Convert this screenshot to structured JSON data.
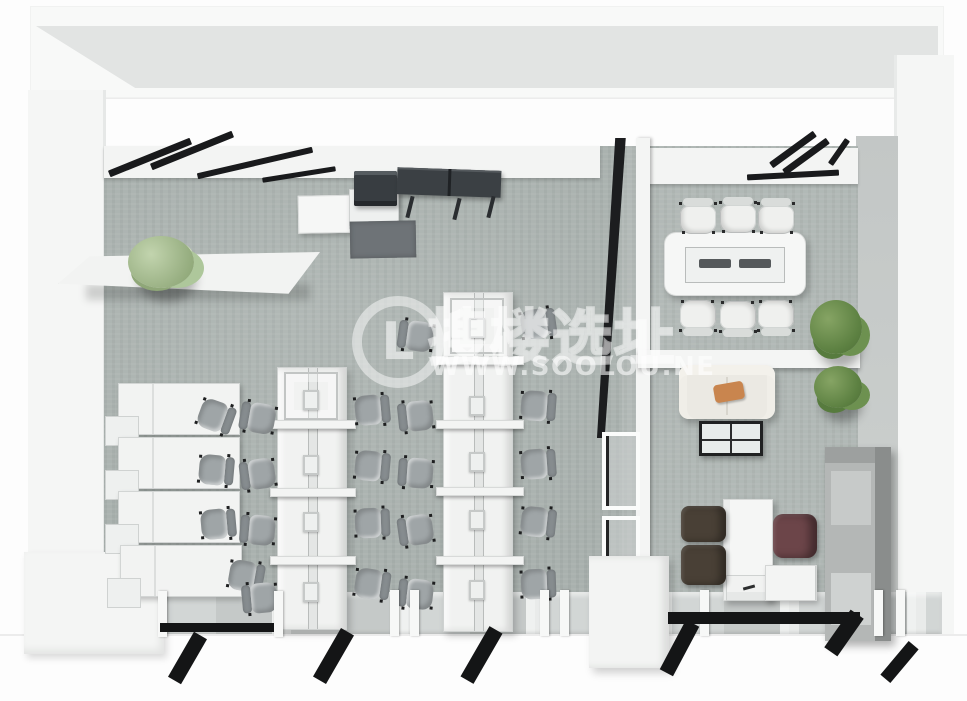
{
  "watermark": {
    "logo_glyph": "L",
    "brand_cjk": "搜楼选址",
    "brand_url": "WWW.SOOLOU.NE"
  },
  "scene": {
    "type": "3d-office-floorplan-render",
    "rooms": [
      "open-office",
      "conference-room",
      "lounge",
      "private-office"
    ],
    "palette": {
      "floor": "#a9b1ae",
      "wall_white": "#f5f6f5",
      "wall_gray": "#c9cdcb",
      "mullion_black": "#191a1c",
      "chair_gray": "#9fa5a7",
      "chair_white": "#eff0ee",
      "chair_brown": "#494036",
      "chair_maroon": "#6c4549",
      "sofa_cream": "#ebe9e3",
      "pillow_orange": "#c9854e",
      "plant_green": "#5d8142",
      "plant_light_green": "#9ab184",
      "cabinet_gray": "#b4b7b6",
      "console_dark": "#3b4044"
    }
  },
  "items": [
    {
      "k": "bank",
      "x": 277,
      "y": 367,
      "w": 70,
      "h": 263
    },
    {
      "k": "bank",
      "x": 443,
      "y": 292,
      "w": 70,
      "h": 340
    },
    {
      "k": "bankframe",
      "x": 284,
      "y": 372,
      "w": 54,
      "h": 48
    },
    {
      "k": "bankframe",
      "x": 450,
      "y": 298,
      "w": 54,
      "h": 56
    },
    {
      "k": "crossbar",
      "x": 270,
      "y": 420,
      "w": 86,
      "h": 9
    },
    {
      "k": "crossbar",
      "x": 270,
      "y": 488,
      "w": 86,
      "h": 9
    },
    {
      "k": "crossbar",
      "x": 270,
      "y": 556,
      "w": 86,
      "h": 9
    },
    {
      "k": "crossbar",
      "x": 436,
      "y": 356,
      "w": 88,
      "h": 9
    },
    {
      "k": "crossbar",
      "x": 436,
      "y": 420,
      "w": 88,
      "h": 9
    },
    {
      "k": "crossbar",
      "x": 436,
      "y": 487,
      "w": 88,
      "h": 9
    },
    {
      "k": "crossbar",
      "x": 436,
      "y": 556,
      "w": 88,
      "h": 9
    },
    {
      "k": "monitor",
      "x": 303,
      "y": 390
    },
    {
      "k": "monitor",
      "x": 303,
      "y": 455
    },
    {
      "k": "monitor",
      "x": 303,
      "y": 512
    },
    {
      "k": "monitor",
      "x": 303,
      "y": 582
    },
    {
      "k": "monitor",
      "x": 469,
      "y": 318
    },
    {
      "k": "monitor",
      "x": 469,
      "y": 396
    },
    {
      "k": "monitor",
      "x": 469,
      "y": 452
    },
    {
      "k": "monitor",
      "x": 469,
      "y": 510
    },
    {
      "k": "monitor",
      "x": 469,
      "y": 580
    },
    {
      "k": "wallunit",
      "x": 118,
      "y": 383
    },
    {
      "k": "wallunit",
      "x": 118,
      "y": 437
    },
    {
      "k": "wallunit",
      "x": 118,
      "y": 491
    },
    {
      "k": "wallunit",
      "x": 120,
      "y": 545
    },
    {
      "k": "chair",
      "x": 196,
      "y": 398,
      "r": 200
    },
    {
      "k": "chair",
      "x": 196,
      "y": 452,
      "r": 185
    },
    {
      "k": "chair",
      "x": 198,
      "y": 506,
      "r": 175
    },
    {
      "k": "chair",
      "x": 226,
      "y": 558,
      "r": 190
    },
    {
      "k": "chair",
      "x": 240,
      "y": 400,
      "r": 10
    },
    {
      "k": "chair",
      "x": 240,
      "y": 456,
      "r": -8
    },
    {
      "k": "chair",
      "x": 240,
      "y": 512,
      "r": 5
    },
    {
      "k": "chair",
      "x": 242,
      "y": 580,
      "r": -5
    },
    {
      "k": "chair",
      "x": 352,
      "y": 392,
      "r": 175
    },
    {
      "k": "chair",
      "x": 352,
      "y": 448,
      "r": 185
    },
    {
      "k": "chair",
      "x": 352,
      "y": 505,
      "r": 178
    },
    {
      "k": "chair",
      "x": 352,
      "y": 566,
      "r": 188
    },
    {
      "k": "chair",
      "x": 398,
      "y": 318,
      "r": 8
    },
    {
      "k": "chair",
      "x": 398,
      "y": 398,
      "r": -6
    },
    {
      "k": "chair",
      "x": 398,
      "y": 455,
      "r": 4
    },
    {
      "k": "chair",
      "x": 398,
      "y": 512,
      "r": -8
    },
    {
      "k": "chair",
      "x": 398,
      "y": 576,
      "r": 6
    },
    {
      "k": "chair",
      "x": 518,
      "y": 306,
      "r": 172
    },
    {
      "k": "chair",
      "x": 518,
      "y": 388,
      "r": 184
    },
    {
      "k": "chair",
      "x": 518,
      "y": 446,
      "r": 176
    },
    {
      "k": "chair",
      "x": 518,
      "y": 504,
      "r": 186
    },
    {
      "k": "chair",
      "x": 518,
      "y": 566,
      "r": 178
    },
    {
      "k": "wchair",
      "x": 679,
      "y": 196,
      "r": 90
    },
    {
      "k": "wchair",
      "x": 719,
      "y": 195,
      "r": 90
    },
    {
      "k": "wchair",
      "x": 757,
      "y": 196,
      "r": 90
    },
    {
      "k": "wchair",
      "x": 679,
      "y": 296,
      "r": 270
    },
    {
      "k": "wchair",
      "x": 719,
      "y": 297,
      "r": 270
    },
    {
      "k": "wchair",
      "x": 757,
      "y": 296,
      "r": 270
    },
    {
      "k": "bchair",
      "x": 681,
      "y": 506,
      "w": 45,
      "h": 36
    },
    {
      "k": "bchair",
      "x": 681,
      "y": 545,
      "w": 45,
      "h": 40
    },
    {
      "k": "mchair",
      "x": 773,
      "y": 514,
      "w": 44,
      "h": 44
    },
    {
      "k": "wbar",
      "x": 106,
      "y": 154,
      "w": 88,
      "h": 7,
      "r": -22
    },
    {
      "k": "wbar",
      "x": 148,
      "y": 147,
      "w": 88,
      "h": 7,
      "r": -22
    },
    {
      "k": "wbar",
      "x": 196,
      "y": 160,
      "w": 118,
      "h": 6,
      "r": -13
    },
    {
      "k": "wbar",
      "x": 262,
      "y": 172,
      "w": 74,
      "h": 5,
      "r": -9
    },
    {
      "k": "wbar",
      "x": 766,
      "y": 146,
      "w": 54,
      "h": 7,
      "r": -36
    },
    {
      "k": "wbar",
      "x": 779,
      "y": 153,
      "w": 54,
      "h": 7,
      "r": -36
    },
    {
      "k": "wbar",
      "x": 747,
      "y": 172,
      "w": 92,
      "h": 6,
      "r": -3
    },
    {
      "k": "wbar",
      "x": 824,
      "y": 149,
      "w": 30,
      "h": 6,
      "r": -55
    },
    {
      "k": "post",
      "x": 158,
      "y": 591
    },
    {
      "k": "post",
      "x": 274,
      "y": 591
    },
    {
      "k": "post",
      "x": 390,
      "y": 590
    },
    {
      "k": "post",
      "x": 410,
      "y": 590
    },
    {
      "k": "post",
      "x": 540,
      "y": 590
    },
    {
      "k": "post",
      "x": 560,
      "y": 590
    },
    {
      "k": "post",
      "x": 700,
      "y": 590
    },
    {
      "k": "post",
      "x": 874,
      "y": 590
    },
    {
      "k": "post",
      "x": 896,
      "y": 590
    },
    {
      "k": "bar",
      "x": 160,
      "y": 623,
      "w": 114,
      "h": 9
    },
    {
      "k": "bar",
      "x": 668,
      "y": 612,
      "w": 192,
      "h": 12
    },
    {
      "k": "stripe",
      "x": 180,
      "y": 632,
      "w": 15,
      "h": 52,
      "r": 30
    },
    {
      "k": "stripe",
      "x": 326,
      "y": 628,
      "w": 15,
      "h": 56,
      "r": 30
    },
    {
      "k": "stripe",
      "x": 474,
      "y": 626,
      "w": 15,
      "h": 58,
      "r": 30
    },
    {
      "k": "stripe",
      "x": 672,
      "y": 620,
      "w": 15,
      "h": 56,
      "r": 28
    },
    {
      "k": "stripe",
      "x": 836,
      "y": 610,
      "w": 16,
      "h": 46,
      "r": 35
    },
    {
      "k": "stripe",
      "x": 893,
      "y": 640,
      "w": 13,
      "h": 44,
      "r": 40
    },
    {
      "k": "plant",
      "x": 128,
      "y": 236,
      "w": 66,
      "h": 52,
      "v": "light"
    },
    {
      "k": "plant",
      "x": 810,
      "y": 300,
      "w": 52,
      "h": 54,
      "v": "dark"
    },
    {
      "k": "plant",
      "x": 814,
      "y": 366,
      "w": 48,
      "h": 42,
      "v": "dark"
    }
  ]
}
